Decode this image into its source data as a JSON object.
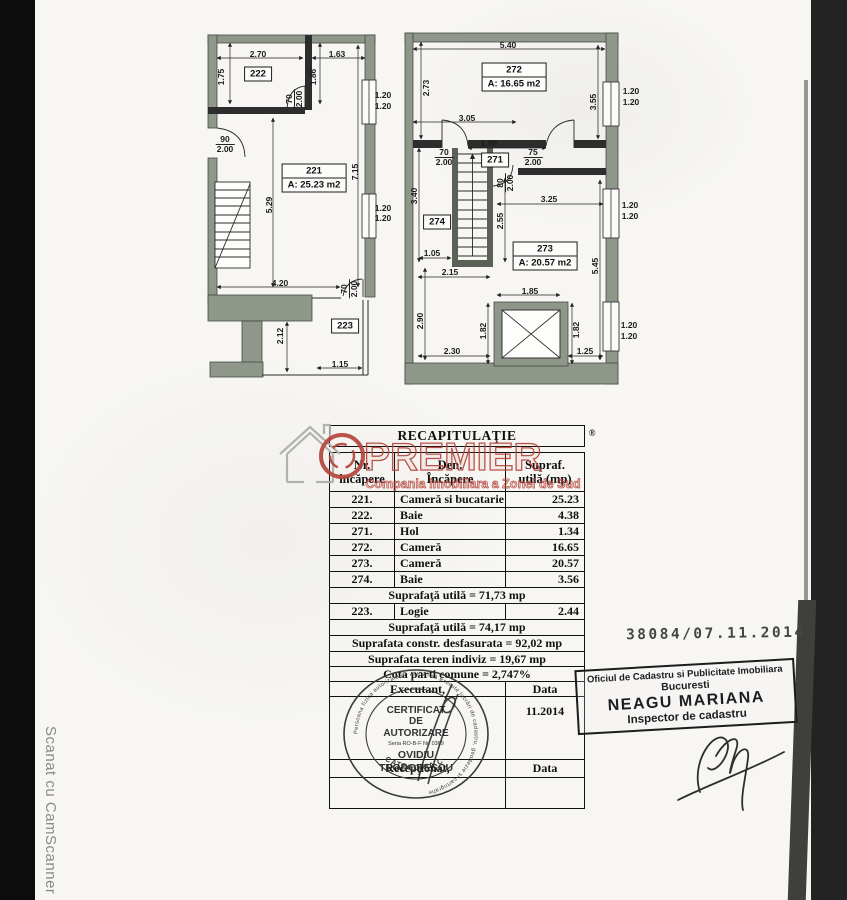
{
  "page": {
    "scan_footer": "Scanat cu CamScanner",
    "registry_number": "38084/07.11.2014"
  },
  "watermark": {
    "brand": "PREMIER",
    "registered": "®",
    "tagline": "Compania imobiliara a Zonei de Sud",
    "brand_color": "#b5463c"
  },
  "plans": {
    "left": {
      "dims": [
        "2.70",
        "1.63",
        "1.75",
        "1.86",
        "70",
        "2.00",
        "1.20",
        "1.20",
        "90",
        "2.00",
        "7.15",
        "5.29",
        "1.20",
        "1.20",
        "4.20",
        "70",
        "2.00",
        "2.12",
        "1.15"
      ],
      "rooms": {
        "r222": "222",
        "r221_no": "221",
        "r221_area": "A: 25.23 m2",
        "r223": "223"
      }
    },
    "right": {
      "dims": [
        "5.40",
        "2.73",
        "3.55",
        "1.20",
        "1.20",
        "3.05",
        "70",
        "2.00",
        "1.80",
        "75",
        "2.00",
        "80",
        "2.00",
        "3.40",
        "3.25",
        "2.55",
        "1.05",
        "5.45",
        "2.15",
        "2.90",
        "1.85",
        "1.82",
        "1.82",
        "2.30",
        "1.25",
        "1.20",
        "1.20",
        "1.20",
        "1.20"
      ],
      "rooms": {
        "r272_no": "272",
        "r272_area": "A: 16.65 m2",
        "r271": "271",
        "r274": "274",
        "r273_no": "273",
        "r273_area": "A: 20.57 m2"
      }
    }
  },
  "table": {
    "title": "RECAPITULAŢIE",
    "registered": "®",
    "headers": {
      "col1_l1": "Nr.",
      "col1_l2": "încăpere",
      "col2_l1": "Den.",
      "col2_l2": "Încăpere",
      "col3_l1": "Supraf.",
      "col3_l2": "utilă (mp)"
    },
    "rows": [
      {
        "nr": "221.",
        "den": "Cameră si bucatarie",
        "sup": "25.23"
      },
      {
        "nr": "222.",
        "den": "Baie",
        "sup": "4.38"
      },
      {
        "nr": "271.",
        "den": "Hol",
        "sup": "1.34"
      },
      {
        "nr": "272.",
        "den": "Cameră",
        "sup": "16.65"
      },
      {
        "nr": "273.",
        "den": "Cameră",
        "sup": "20.57"
      },
      {
        "nr": "274.",
        "den": "Baie",
        "sup": "3.56"
      }
    ],
    "logie": {
      "nr": "223.",
      "den": "Logie",
      "sup": "2.44"
    },
    "summary_utila1": "Suprafaţă utilă = 71,73 mp",
    "summary_utila2": "Suprafaţă utilă = 74,17 mp",
    "summary_constr": "Suprafata constr. desfasurata = 92,02 mp",
    "summary_teren": "Suprafata teren indiviz = 19,67 mp",
    "summary_cota": "Cota parti comune = 2,747%",
    "executant": "Executant,",
    "data1": "Data",
    "date_value": "11.2014",
    "receptionat": "Recepţionat,",
    "data2": "Data"
  },
  "stamp": {
    "ring": "Persoana fizica autorizata de ANCPI să execute lucrări de cadastru, geodezie și cartografie",
    "line1": "CERTIFICAT",
    "line2": "DE",
    "line3": "AUTORIZARE",
    "line4": "Seria RO-B-F Nr. 0369",
    "line5": "OVIDIU",
    "line6": "TEODORESCU",
    "arc": "CATEGORIA C"
  },
  "office_box": {
    "line1": "Oficiul de Cadastru si Publicitate Imobiliara",
    "line2": "Bucuresti",
    "line3": "NEAGU MARIANA",
    "line4": "Inspector de cadastru"
  }
}
